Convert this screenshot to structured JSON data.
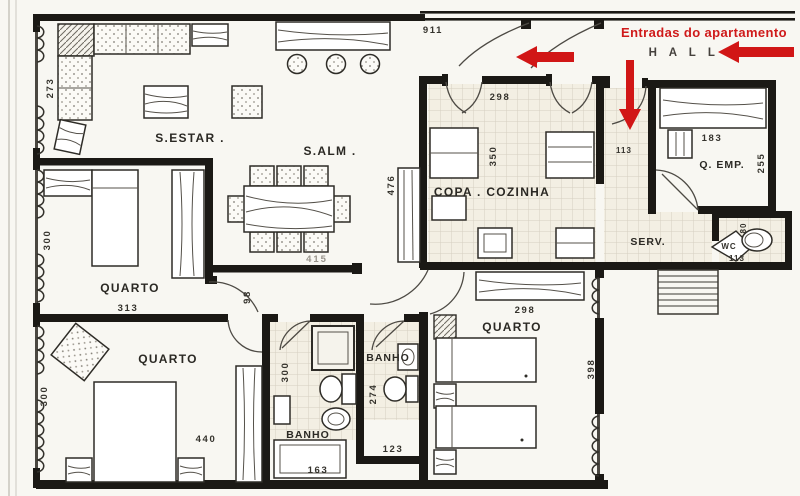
{
  "annotations": {
    "entrance_note": "Entradas do apartamento",
    "hall": "H A L L"
  },
  "rooms": {
    "living": {
      "label": "S.ESTAR .",
      "dim_side": "273"
    },
    "dining": {
      "label": "S.ALM .",
      "dim_wall": "415",
      "dim_cabinet": "476",
      "dim_width": "911"
    },
    "kitchen": {
      "label": "COPA . COZINHA",
      "dim_top": "298",
      "dim_side": "350"
    },
    "service_hall": {
      "dim": "113"
    },
    "maid_room": {
      "label": "Q. EMP.",
      "dim_top": "183",
      "dim_side": "255"
    },
    "service_area": {
      "label": "SERV."
    },
    "wc": {
      "label": "WC",
      "dim_side": "80",
      "dim_bottom": "113"
    },
    "bedroom_mid": {
      "label": "QUARTO",
      "dim_side": "300",
      "dim_bottom": "313"
    },
    "bedroom_bottom": {
      "label": "QUARTO",
      "dim_side": "300",
      "dim_width": "440"
    },
    "bedroom_right": {
      "label": "QUARTO",
      "dim_top": "298",
      "dim_side": "398"
    },
    "bath_1": {
      "label": "BANHO",
      "dim_side": "300",
      "dim_bottom": "163"
    },
    "bath_2": {
      "label": "BANHO",
      "dim_side": "274",
      "dim_bottom": "123"
    },
    "hallway": {
      "dim": "98"
    }
  },
  "colors": {
    "accent_red": "#d11616",
    "wall_black": "#1b1915",
    "paper": "#f8f7f2",
    "tile_line": "#d6cfc0",
    "dim_gray": "#98938b"
  }
}
